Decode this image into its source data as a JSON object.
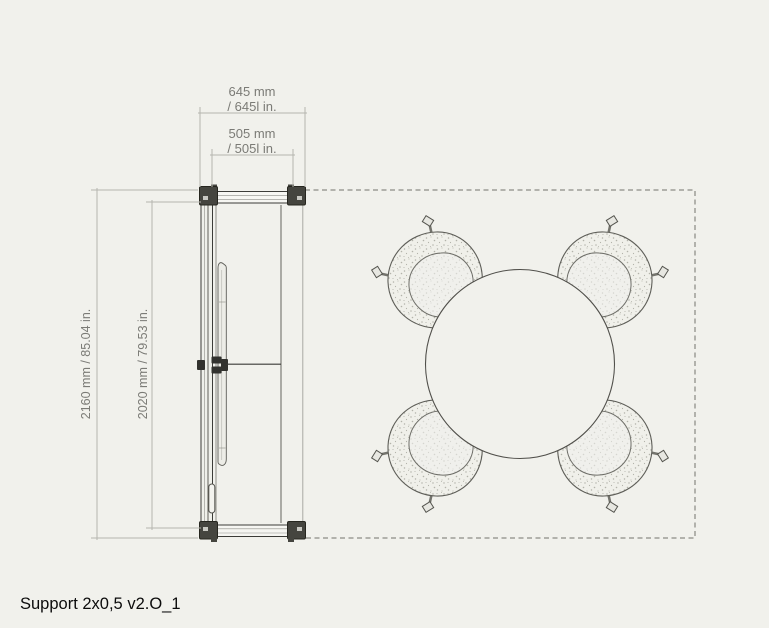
{
  "title": "Support 2x0,5 v2.O_1",
  "dimensions": {
    "width_outer_mm": "645 mm",
    "width_outer_in": "/ 645l in.",
    "width_inner_mm": "505 mm",
    "width_inner_in": "/ 505l in.",
    "height_outer": "2160 mm / 85.04 in.",
    "height_inner": "2020 mm / 79.53 in."
  },
  "colors": {
    "background": "#f1f1ec",
    "dimension_lines": "#b5b5ae",
    "dimension_text": "#7b7b76",
    "structure_outline": "#3a3a36",
    "frame_corner_blocks": "#45453f",
    "chair_outline": "#5e5e58",
    "chair_stipple": "#b3b3aa",
    "table_outline": "#504f4a",
    "dashed_boundary": "#72726c",
    "title_text": "#0c0c0c"
  }
}
